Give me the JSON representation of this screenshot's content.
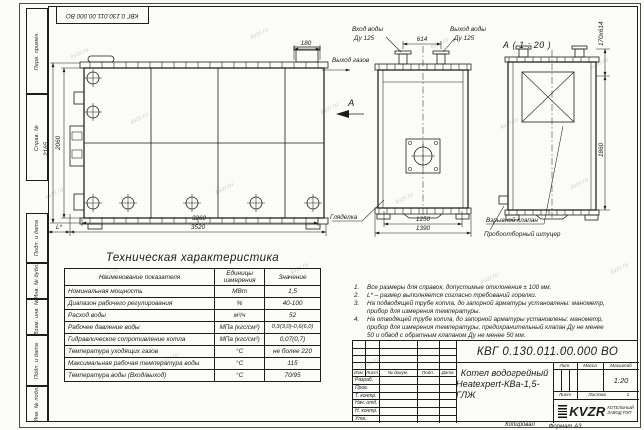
{
  "sheet": {
    "top_stamp": "КВГ 0.130.011.00.000 ВО",
    "watermark": "kvzr.ru",
    "copied_by": "Копировал",
    "format_note": "Формат А3"
  },
  "side_stamps": [
    "Перв. примен.",
    "Справ. №",
    "Подп. и дата",
    "Инв. № дубл.",
    "Взам. инв. №",
    "Подп. и дата",
    "Инв. № подл."
  ],
  "drawing": {
    "view_title": "А ( 1 : 20 )",
    "section_letter": "А",
    "labels": {
      "gas_out": "Выход газов",
      "water_in_1": "Вход воды",
      "water_in_2": "Ду 125",
      "water_out_1": "Выход воды",
      "water_out_2": "Ду 125",
      "sight_glass": "Гляделка",
      "explosion_valve": "Взрывной клапан",
      "sampling_fitting": "Пробоотборный штуцер"
    },
    "dims": {
      "gas_stub_w": "180",
      "h_outer": "2165",
      "h_inner": "2060",
      "len_body": "3260",
      "len_total": "3520",
      "burner_len": "L*",
      "nozzle_span": "614",
      "front_w_inner": "1250",
      "front_w_outer": "1390",
      "hatch_size": "170х614",
      "rear_h": "1860"
    }
  },
  "tech_table": {
    "title": "Техническая характеристика",
    "headers": [
      "Наименование показателя",
      "Единицы измерения",
      "Значение"
    ],
    "rows": [
      [
        "Номинальная мощность",
        "МВт",
        "1,5"
      ],
      [
        "Диапазон рабочего регулирования",
        "%",
        "40-100"
      ],
      [
        "Расход воды",
        "м³/ч",
        "52"
      ],
      [
        "Рабочее давление воды",
        "МПа (кгс/см²)",
        "0,3(3,0)-0,6(6,0)"
      ],
      [
        "Гидравлическое сопротивление котла",
        "МПа (кгс/см²)",
        "0,07(0,7)"
      ],
      [
        "Температура уходящих газов",
        "°С",
        "не более 220"
      ],
      [
        "Максимальная рабочая температура воды",
        "°С",
        "115"
      ],
      [
        "Температура воды (Вход/выход)",
        "°С",
        "70/95"
      ]
    ]
  },
  "notes": [
    {
      "n": "1.",
      "t": "Все размеры для справок, допустимые отклонения ± 100 мм."
    },
    {
      "n": "2.",
      "t": "L* – размер выполняется согласно требований горелки."
    },
    {
      "n": "3.",
      "t": "На подводящей трубе котла, до запорной арматуры установлены: манометр, прибор для измерения температуры."
    },
    {
      "n": "4.",
      "t": "На отводящей трубе котла, до запорной арматуры установлены: манометр, прибор для измерения температуры, предохранительный клапан Ду не менее 50 и обвод с обратным клапаном Ду не менее 50 мм."
    }
  ],
  "title_block": {
    "doc_number": "КВГ 0.130.011.00.000 ВО",
    "product_line1": "Котел водогрейный",
    "product_line2": "Heatexpert-КВа-1,5-ГЛЖ",
    "cols": [
      "Изм.",
      "Лист",
      "№ докум.",
      "Подп.",
      "Дата"
    ],
    "rows": [
      "Разраб.",
      "Пров.",
      "Т. контр.",
      "Нач. отд.",
      "Н. контр.",
      "Утв."
    ],
    "lit": "Лит.",
    "mass": "Масса",
    "scale_label": "Масштаб",
    "scale": "1:20",
    "sheet": "Лист",
    "sheets": "Листов",
    "sheets_num": "1",
    "logo": "KVZR",
    "logo_cap1": "КОТЕЛЬНЫЙ",
    "logo_cap2": "ЗАВОД РЭП"
  }
}
